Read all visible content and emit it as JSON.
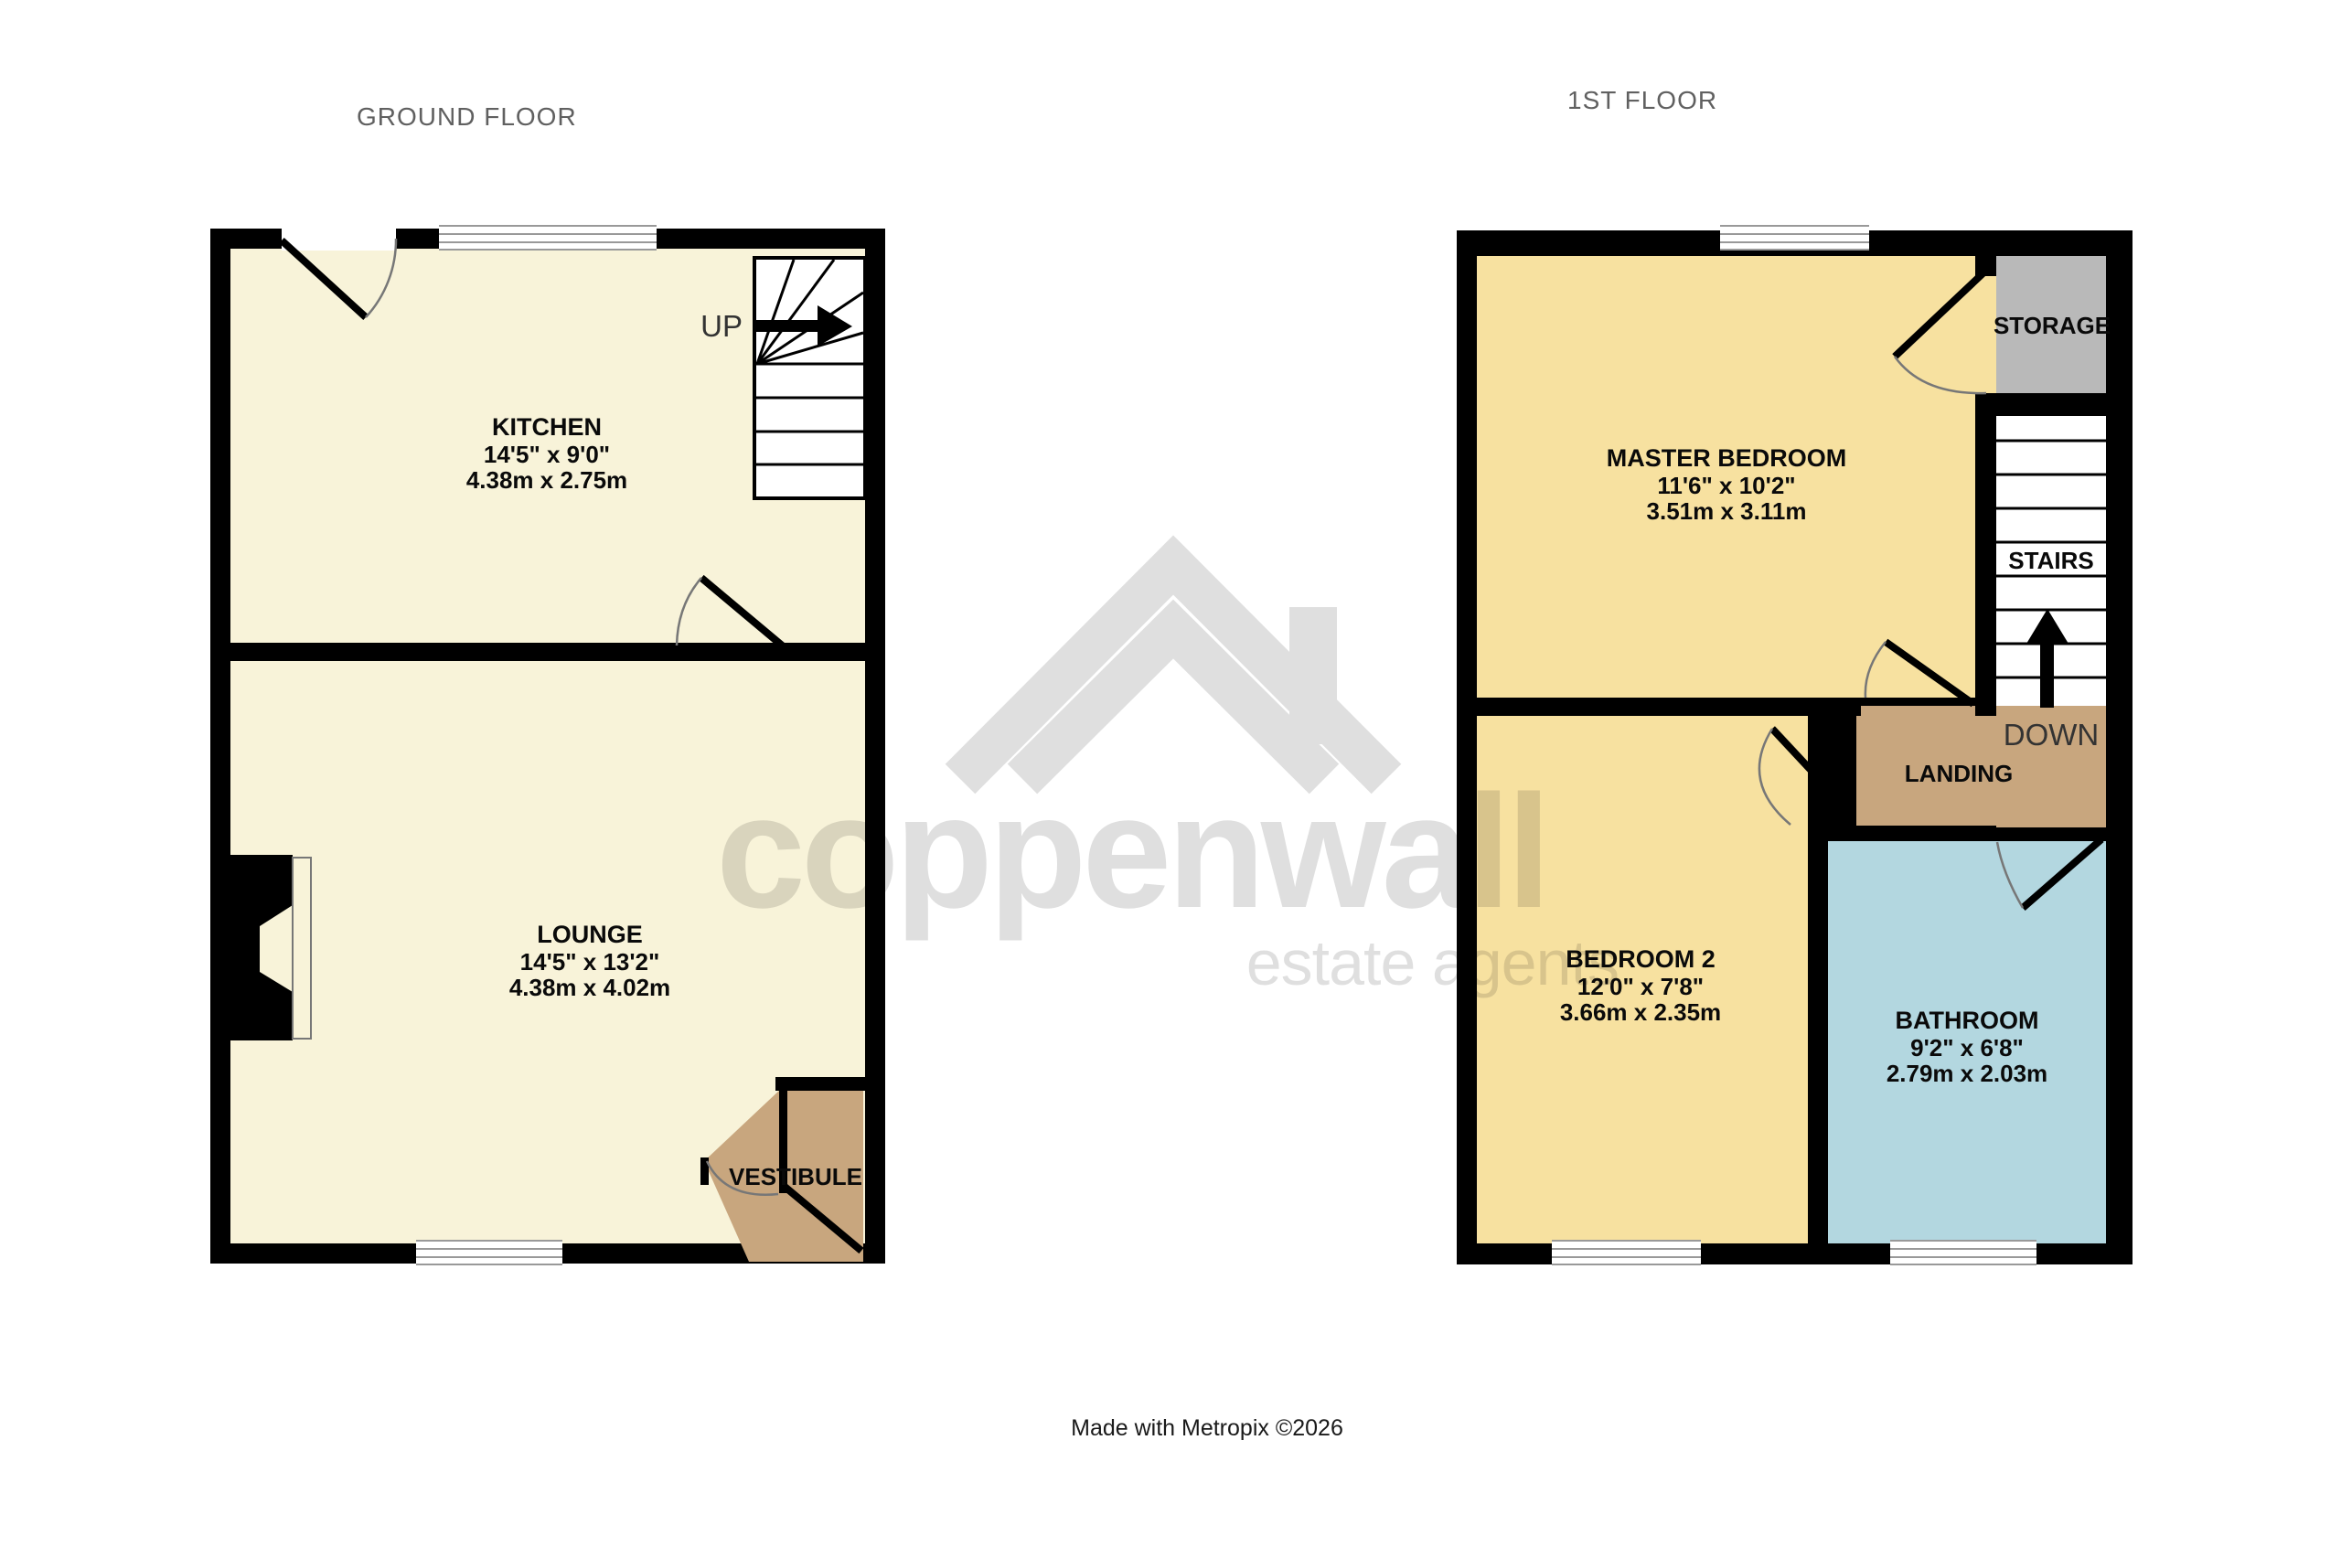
{
  "titles": {
    "ground": "GROUND FLOOR",
    "first": "1ST FLOOR"
  },
  "footer_credit": "Made with Metropix ©2026",
  "watermark": {
    "brand": "coppenwall",
    "tagline": "estate agents",
    "logo": "roof-chevron-with-chimney-icon"
  },
  "ground_floor": {
    "kitchen": {
      "name": "KITCHEN",
      "imperial": "14'5\" x 9'0\"",
      "metric": "4.38m x 2.75m"
    },
    "lounge": {
      "name": "LOUNGE",
      "imperial": "14'5\" x 13'2\"",
      "metric": "4.38m x 4.02m"
    },
    "vestibule_label": "VESTIBULE",
    "up_label": "UP"
  },
  "first_floor": {
    "master_bedroom": {
      "name": "MASTER BEDROOM",
      "imperial": "11'6\" x 10'2\"",
      "metric": "3.51m x 3.11m"
    },
    "bedroom2": {
      "name": "BEDROOM 2",
      "imperial": "12'0\" x 7'8\"",
      "metric": "3.66m x 2.35m"
    },
    "bathroom": {
      "name": "BATHROOM",
      "imperial": "9'2\" x 6'8\"",
      "metric": "2.79m x 2.03m"
    },
    "storage_label": "STORAGE",
    "stairs_label": "STAIRS",
    "landing_label": "LANDING",
    "down_label": "DOWN"
  },
  "colors": {
    "wall": "#000000",
    "ground_room_fill": "#f8f3d9",
    "bedroom_fill": "#f7e1a0",
    "landing_fill": "#c8a67e",
    "bathroom_fill": "#b3d7e0",
    "storage_fill": "#b9b9b9",
    "window_line": "#999999",
    "door_arc": "#777777",
    "title_text": "#606060",
    "watermark_gray": "#e0e0e0"
  }
}
